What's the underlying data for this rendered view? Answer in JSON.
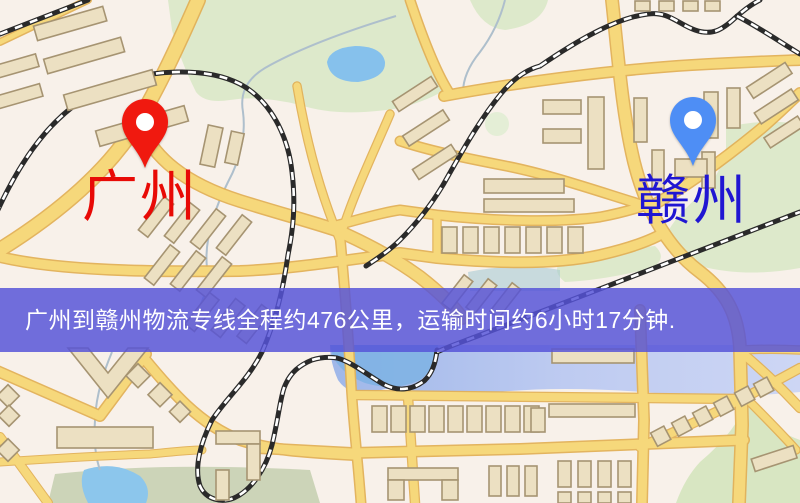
{
  "map": {
    "origin_marker": {
      "label": "广州",
      "icon": "red-location-pin",
      "pin_color": "#f0190f",
      "label_color": "#e80a06"
    },
    "destination_marker": {
      "label": "赣州",
      "icon": "blue-location-pin",
      "pin_color": "#4e8ef5",
      "label_color": "#2016d2"
    },
    "banner": {
      "text": "广州到赣州物流专线全程约476公里，运输时间约6小时17分钟.",
      "distance": "约476公里",
      "duration": "约6小时17分钟",
      "background_color": "#5553d8",
      "text_color": "#ffffff"
    },
    "legend_colors": {
      "land": "#f8f1ea",
      "road": "#f6d87b",
      "road_edge": "#e2b158",
      "building": "#ece0c2",
      "building_outline": "#a69472",
      "park_green": "#dde9cb",
      "water_blue": "#86c1ec",
      "water_band": "#b7c8ef",
      "railway": "#2a2a2a"
    }
  }
}
